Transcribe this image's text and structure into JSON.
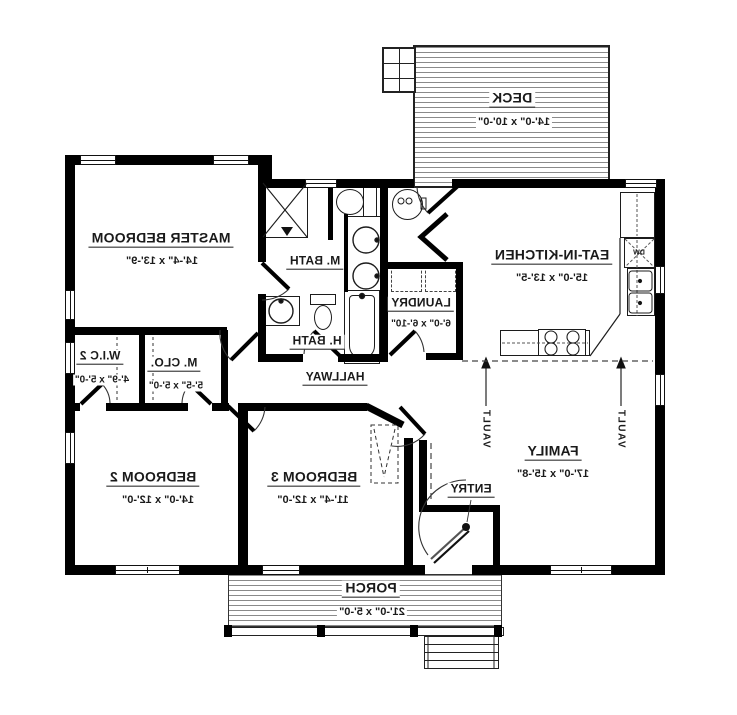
{
  "plan": {
    "rooms": [
      {
        "id": "deck",
        "name": "DECK",
        "dims": "14'-0\" x 10'-0\""
      },
      {
        "id": "master-bedroom",
        "name": "MASTER BEDROOM",
        "dims": "14'-4\" x 13'-9\""
      },
      {
        "id": "master-bath",
        "name": "M. BATH",
        "dims": ""
      },
      {
        "id": "hall-bath",
        "name": "H. BATH",
        "dims": ""
      },
      {
        "id": "laundry",
        "name": "LAUNDRY",
        "dims": "6'-0\" x 6'-10\""
      },
      {
        "id": "eat-in-kitchen",
        "name": "EAT-IN-KITCHEN",
        "dims": "15'-0\" x 13'-5\""
      },
      {
        "id": "hallway",
        "name": "HALLWAY",
        "dims": ""
      },
      {
        "id": "walk-in-closet-2",
        "name": "W.I.C 2",
        "dims": "4'-9\" x 5'-0\""
      },
      {
        "id": "master-closet",
        "name": "M. CLO.",
        "dims": "5'-5\" x 5'-0\""
      },
      {
        "id": "bedroom-2",
        "name": "BEDROOM 2",
        "dims": "14'-0\" x 12'-0\""
      },
      {
        "id": "bedroom-3",
        "name": "BEDROOM 3",
        "dims": "11'-4\" x 12'-0\""
      },
      {
        "id": "family",
        "name": "FAMILY",
        "dims": "17'-0\" x 15'-8\""
      },
      {
        "id": "entry",
        "name": "ENTRY",
        "dims": ""
      },
      {
        "id": "porch",
        "name": "PORCH",
        "dims": "21'-0\" x 5'-0\""
      }
    ],
    "annotations": {
      "vault": "VAULT",
      "dishwasher": "DW"
    },
    "colors": {
      "wall": "#000000",
      "line": "#222222",
      "hatch": "#8a8a8a",
      "background": "#ffffff",
      "text": "#1a1a1a"
    }
  }
}
